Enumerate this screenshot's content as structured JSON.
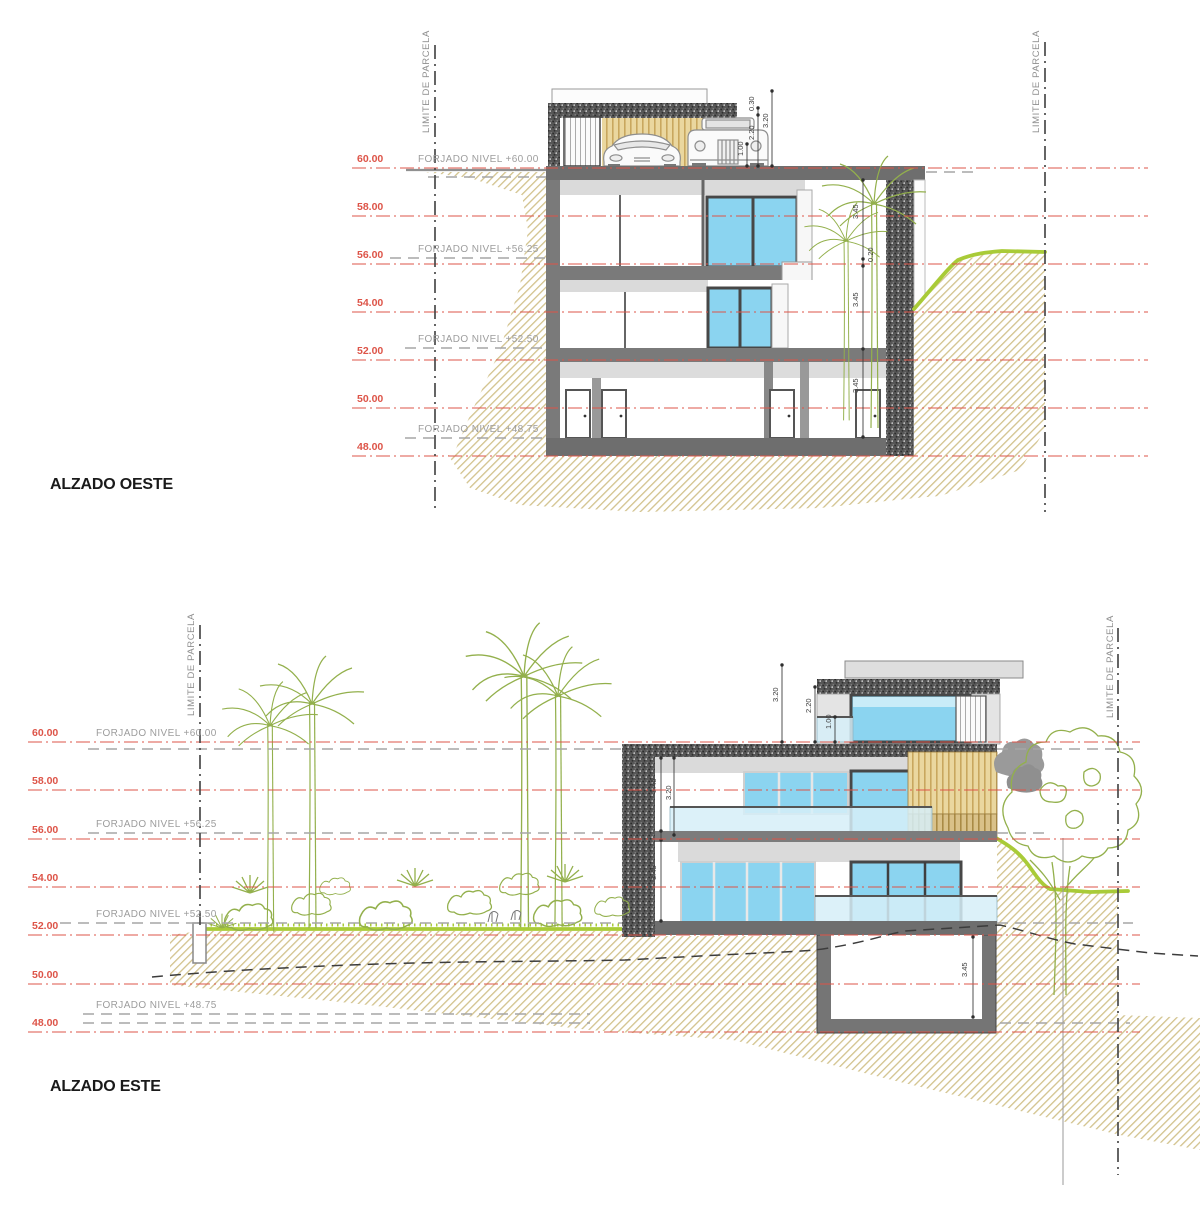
{
  "colors": {
    "level_red": "#dd5448",
    "forjado_gray": "#9d9d9d",
    "hatch_tan": "#d2c28c",
    "grass_green": "#a9cb38",
    "plant_green": "#93b04c",
    "window_blue": "#8bd4f0",
    "wall_gray": "#6e6e6e",
    "title_black": "#1a1a1a"
  },
  "d1": {
    "title": "ALZADO OESTE",
    "limit_left": "LIMITE DE PARCELA",
    "limit_right": "LIMITE DE PARCELA",
    "levels": [
      "60.00",
      "58.00",
      "56.00",
      "54.00",
      "52.00",
      "50.00",
      "48.00"
    ],
    "forjados": [
      "FORJADO NIVEL +60.00",
      "FORJADO NIVEL +56.25",
      "FORJADO NIVEL +52.50",
      "FORJADO NIVEL +48.75"
    ],
    "dims": {
      "d030": "0.30",
      "d220": "2.20",
      "d100": "1.00",
      "d320": "3.20",
      "d345a": "3.45",
      "d020": "0.20",
      "d345b": "3.45",
      "d345c": "3.45"
    }
  },
  "d2": {
    "title": "ALZADO ESTE",
    "limit_left": "LIMITE DE PARCELA",
    "limit_right": "LIMITE DE PARCELA",
    "levels": [
      "60.00",
      "58.00",
      "56.00",
      "54.00",
      "52.00",
      "50.00",
      "48.00"
    ],
    "forjados": [
      "FORJADO NIVEL +60.00",
      "FORJADO NIVEL +56.25",
      "FORJADO NIVEL +52.50",
      "FORJADO NIVEL +48.75"
    ],
    "dims": {
      "d320": "3.20",
      "d220": "2.20",
      "d100": "1.00",
      "d345a": "3.45",
      "d320b": "3.20",
      "d345b": "3.45",
      "d345base": "3.45"
    }
  }
}
